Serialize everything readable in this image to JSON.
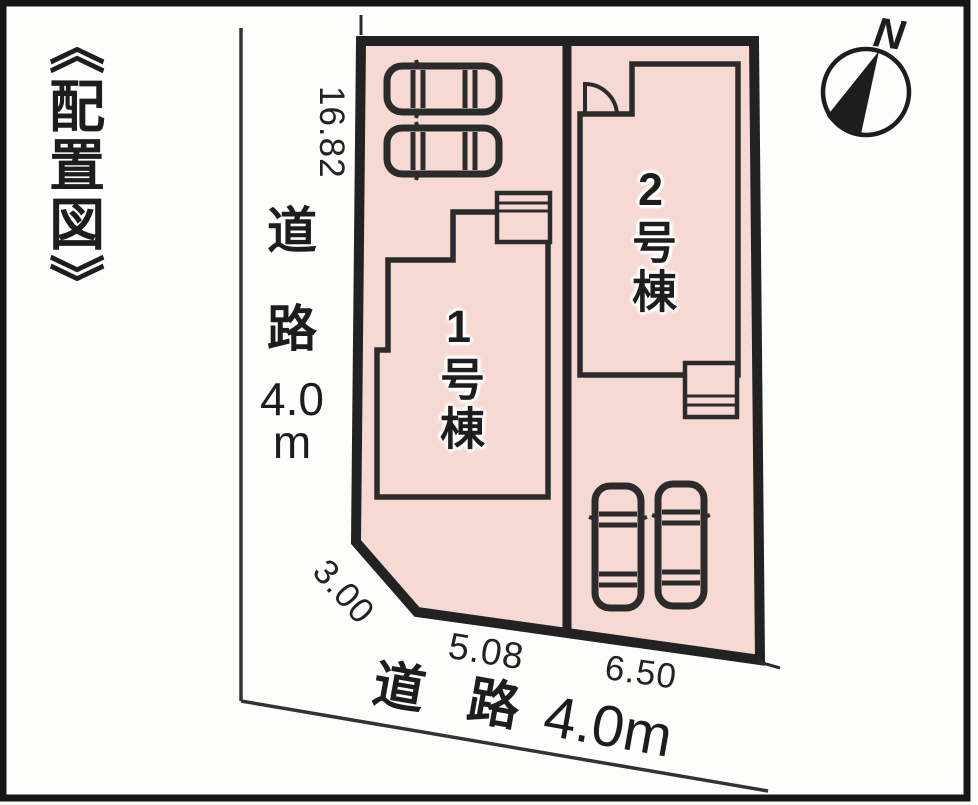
{
  "title": "《配置図》",
  "compass": {
    "north_label": "N"
  },
  "roads": {
    "left": {
      "full_text": "道路4.0m",
      "parts": [
        "道",
        "路",
        "4.0",
        "m"
      ]
    },
    "bottom": {
      "full_text": "道路4.0m",
      "parts": [
        "道",
        "路",
        "4.0m"
      ]
    }
  },
  "dimensions": {
    "left_side": "16.82",
    "corner_cut": "3.00",
    "lot1_frontage": "5.08",
    "lot2_frontage": "6.50"
  },
  "lots": [
    {
      "building_label": "1号棟",
      "parking_cars": 2
    },
    {
      "building_label": "2号棟",
      "parking_cars": 2
    }
  ],
  "colors": {
    "lot_fill": "#f7d9d4",
    "line": "#2b2b2b",
    "boundary": "#222222",
    "background": "#fdfdfc"
  }
}
